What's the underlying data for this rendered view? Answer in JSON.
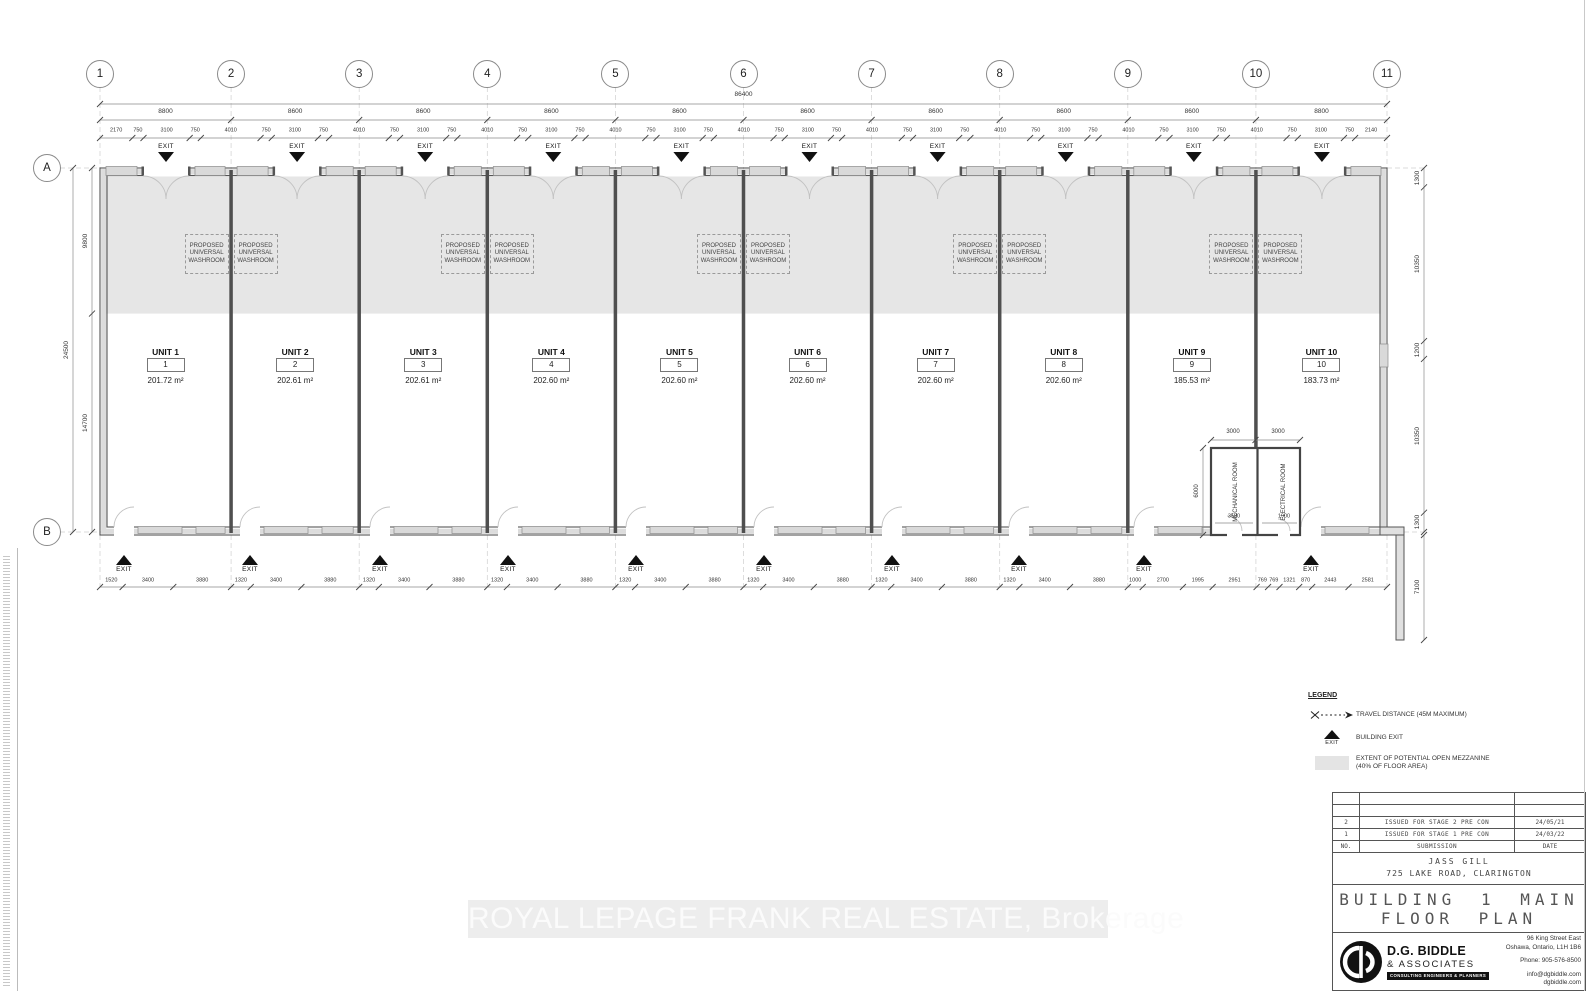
{
  "sheet": {
    "watermark": "ROYAL LEPAGE FRANK REAL ESTATE, Brokerage"
  },
  "colors": {
    "mezzanine_fill": "#e6e6e6",
    "wall_line": "#555555",
    "exit_marker": "#111111"
  },
  "plan": {
    "grid_columns": [
      "1",
      "2",
      "3",
      "4",
      "5",
      "6",
      "7",
      "8",
      "9",
      "10",
      "11"
    ],
    "grid_rows": [
      "A",
      "B"
    ],
    "overall_width_dim": "86400",
    "span_dims": [
      "8800",
      "8600",
      "8600",
      "8600",
      "8600",
      "8600",
      "8600",
      "8600",
      "8600",
      "8800"
    ],
    "sub_dims": [
      "2170",
      "750",
      "3100",
      "750",
      "4010",
      "750",
      "3100",
      "750",
      "4010",
      "750",
      "3100",
      "750",
      "4010",
      "750",
      "3100",
      "750",
      "4010",
      "750",
      "3100",
      "750",
      "4010",
      "750",
      "3100",
      "750",
      "4010",
      "750",
      "3100",
      "750",
      "4010",
      "750",
      "3100",
      "750",
      "4010",
      "750",
      "3100",
      "750",
      "4010",
      "750",
      "3100",
      "750",
      "2140"
    ],
    "bottom_dims": [
      "1520",
      "3400",
      "3880",
      "1320",
      "3400",
      "3880",
      "1320",
      "3400",
      "3880",
      "1320",
      "3400",
      "3880",
      "1320",
      "3400",
      "3880",
      "1320",
      "3400",
      "3880",
      "1320",
      "3400",
      "3880",
      "1320",
      "3400",
      "3880",
      "1000",
      "2700",
      "1995",
      "2951",
      "769",
      "769",
      "1321",
      "870",
      "2443",
      "2581"
    ],
    "left_dims": {
      "overall": "24500",
      "top": "9800",
      "bottom": "14700"
    },
    "right_dims": [
      "1300",
      "10350",
      "1200",
      "10350",
      "1300"
    ],
    "right_below_dim": "7100",
    "exit_label": "EXIT",
    "washroom_label": "PROPOSED UNIVERSAL WASHROOM",
    "units": [
      {
        "name": "UNIT 1",
        "number": "1",
        "area": "201.72 m²"
      },
      {
        "name": "UNIT 2",
        "number": "2",
        "area": "202.61 m²"
      },
      {
        "name": "UNIT 3",
        "number": "3",
        "area": "202.61 m²"
      },
      {
        "name": "UNIT 4",
        "number": "4",
        "area": "202.60 m²"
      },
      {
        "name": "UNIT 5",
        "number": "5",
        "area": "202.60 m²"
      },
      {
        "name": "UNIT 6",
        "number": "6",
        "area": "202.60 m²"
      },
      {
        "name": "UNIT 7",
        "number": "7",
        "area": "202.60 m²"
      },
      {
        "name": "UNIT 8",
        "number": "8",
        "area": "202.60 m²"
      },
      {
        "name": "UNIT 9",
        "number": "9",
        "area": "185.53 m²"
      },
      {
        "name": "UNIT 10",
        "number": "10",
        "area": "183.73 m²"
      }
    ],
    "rooms": {
      "mechanical": "MECHANICAL ROOM",
      "electrical": "ELECTRICAL ROOM",
      "dims": {
        "top_left": "3000",
        "top_right": "3000",
        "left": "6000",
        "mech_width": "3530",
        "elec_width": "1900"
      }
    }
  },
  "legend": {
    "title": "LEGEND",
    "items": [
      {
        "symbol": "travel-distance",
        "label": "TRAVEL DISTANCE (45M MAXIMUM)"
      },
      {
        "symbol": "building-exit",
        "symbol_text": "EXIT",
        "label": "BUILDING EXIT"
      },
      {
        "symbol": "mezzanine-extent",
        "label": "EXTENT OF POTENTIAL OPEN MEZZANINE (40% OF FLOOR AREA)"
      }
    ]
  },
  "title_block": {
    "revisions": [
      {
        "no": "2",
        "submission": "ISSUED FOR STAGE 2 PRE CON",
        "date": "24/05/21"
      },
      {
        "no": "1",
        "submission": "ISSUED FOR STAGE 1 PRE CON",
        "date": "24/03/22"
      }
    ],
    "revision_headers": {
      "no": "NO.",
      "submission": "SUBMISSION",
      "date": "DATE"
    },
    "client": "JASS GILL",
    "address": "725 LAKE ROAD, CLARINGTON",
    "drawing_title_line1": "BUILDING 1 MAIN",
    "drawing_title_line2": "FLOOR PLAN",
    "firm": {
      "name": "D.G. BIDDLE",
      "sub": "& ASSOCIATES",
      "tagline": "CONSULTING ENGINEERS & PLANNERS",
      "address_line1": "96 King Street East",
      "address_line2": "Oshawa, Ontario, L1H 1B6",
      "phone": "Phone: 905-576-8500",
      "email": "info@dgbiddle.com",
      "web": "dgbiddle.com"
    }
  }
}
